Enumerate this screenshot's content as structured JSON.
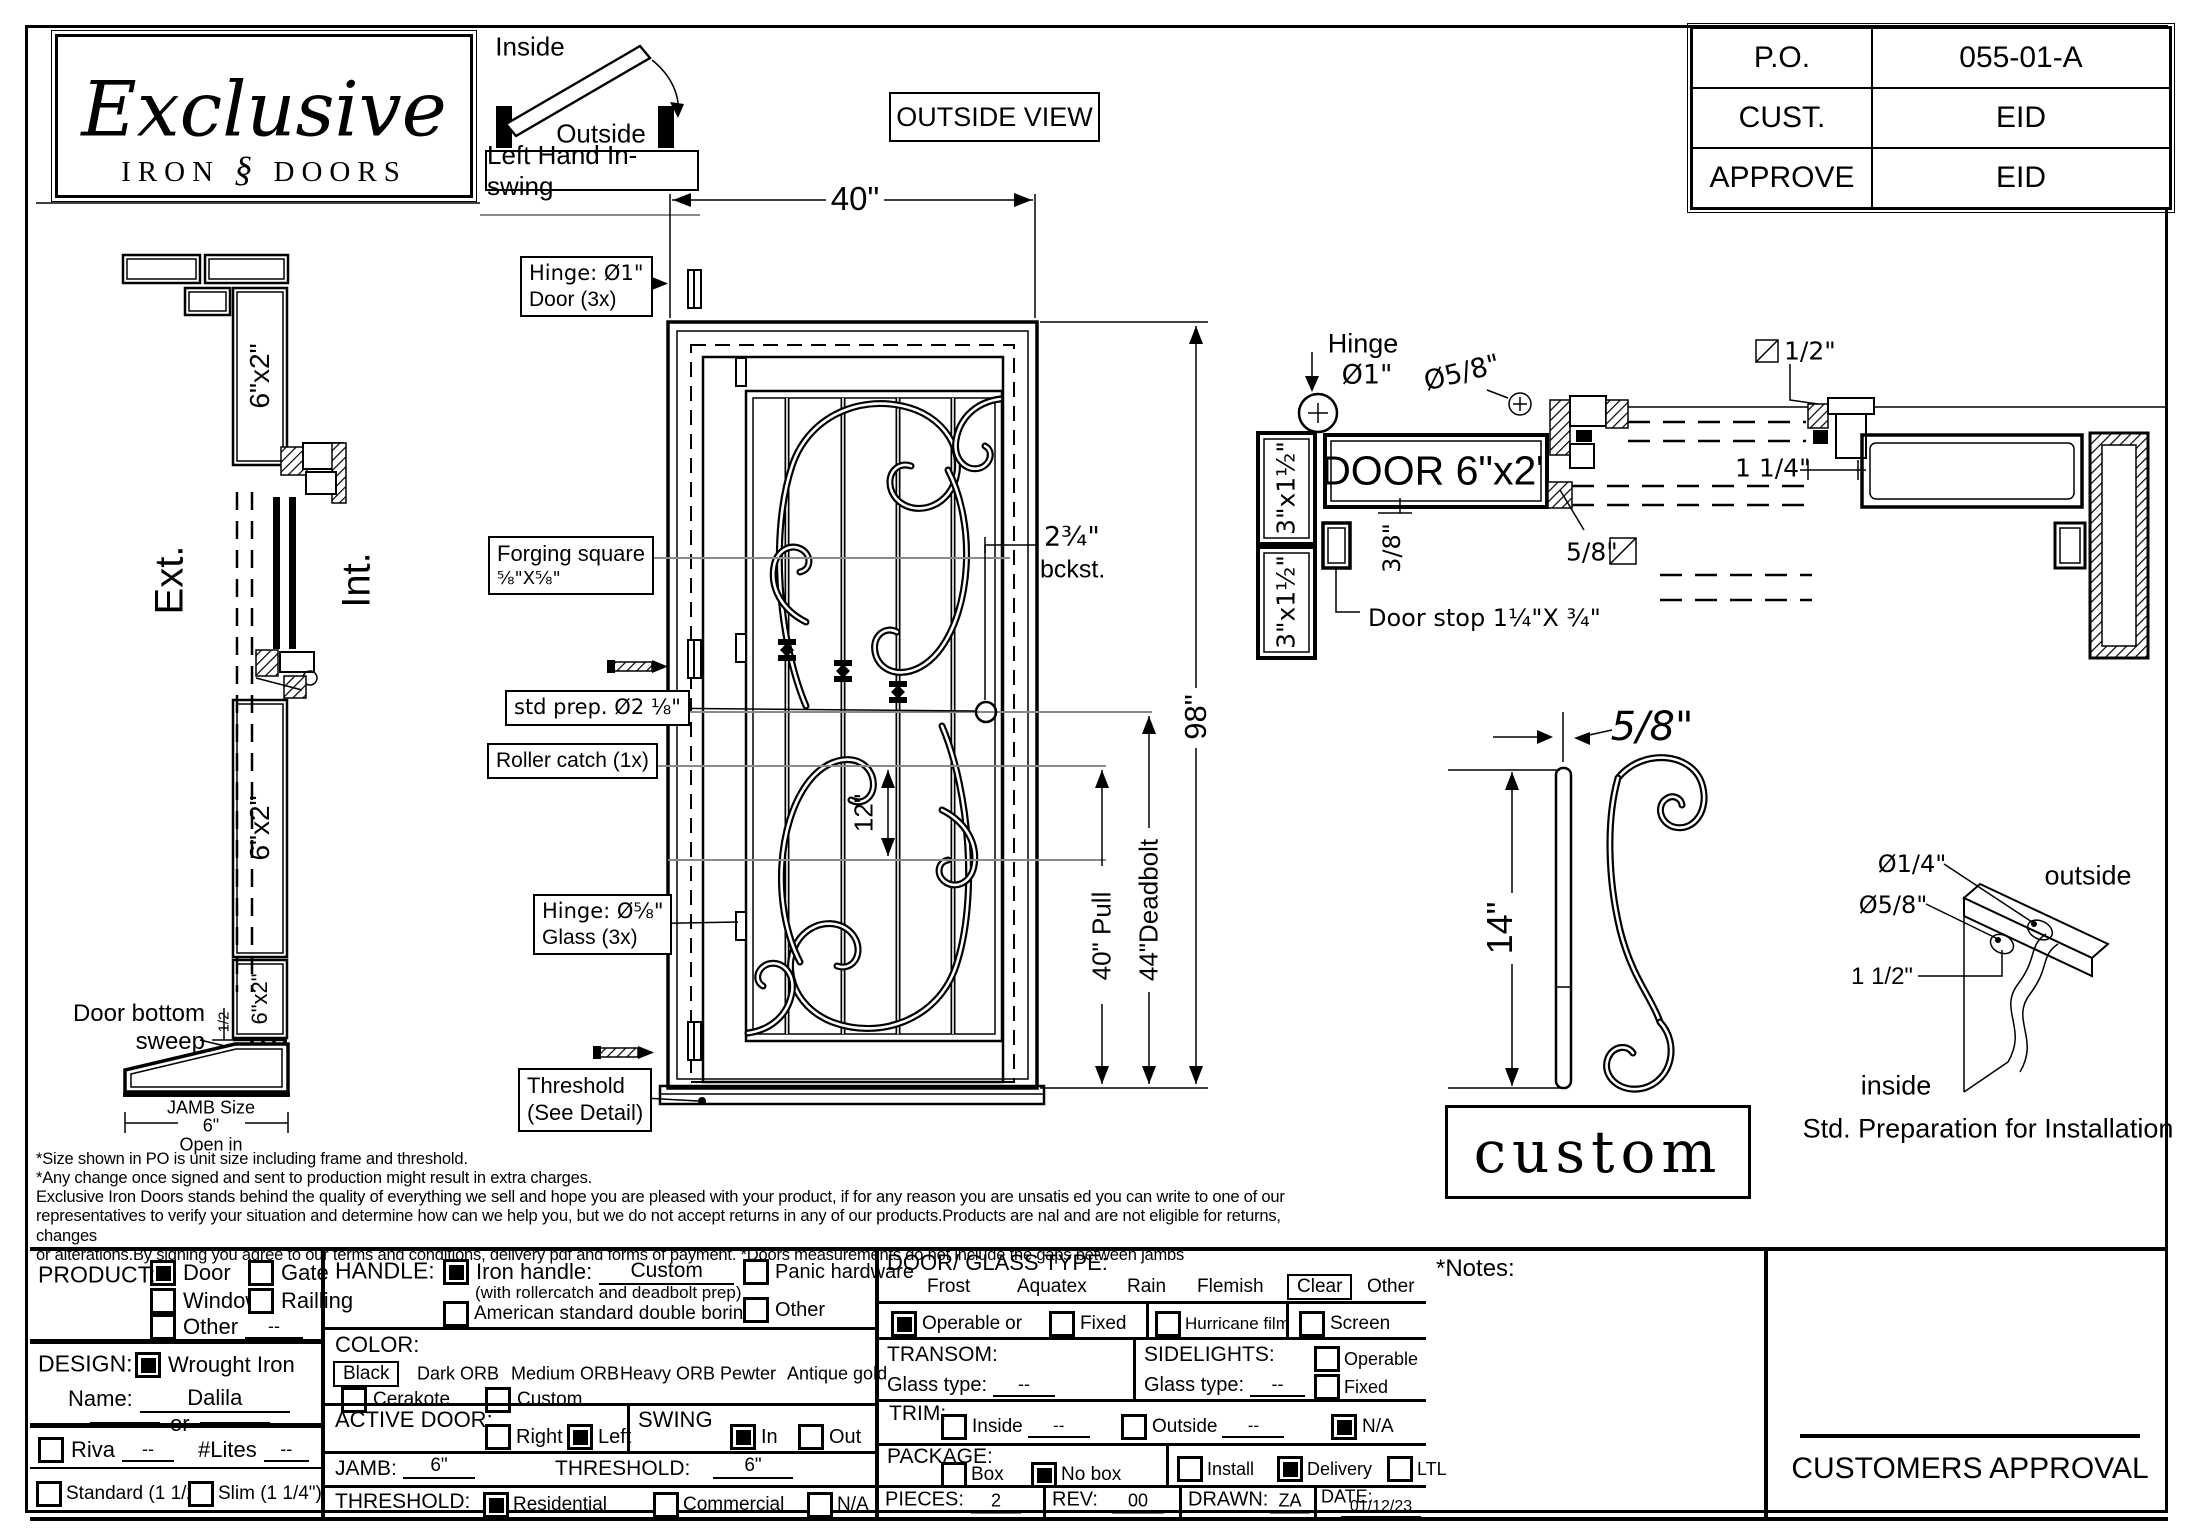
{
  "po_table": {
    "rows": [
      {
        "label": "P.O.",
        "value": "055-01-A"
      },
      {
        "label": "CUST.",
        "value": "EID"
      },
      {
        "label": "APPROVE",
        "value": "EID"
      }
    ]
  },
  "logo": {
    "script": "Exclusive",
    "sub_left": "IRON",
    "ornament": "§",
    "sub_right": "DOORS"
  },
  "swing_diagram": {
    "inside": "Inside",
    "outside": "Outside",
    "caption": "Left Hand In-swing"
  },
  "outside_view": "OUTSIDE VIEW",
  "section_view": {
    "ext": "Ext.",
    "int": "Int.",
    "frame_top": "6\"x2\"",
    "frame_mid": "6\"x2\"",
    "frame_bot": "6\"x2\"",
    "door_bottom_line1": "Door bottom",
    "door_bottom_line2": "sweep",
    "sweep_dim": "1/2",
    "jamb_size_label": "JAMB Size",
    "jamb_size_value": "6\"",
    "open_in": "Open in"
  },
  "elevation": {
    "width_dim": "40\"",
    "height_dim": "98\"",
    "bottom_dim": "12\"",
    "backset_line1": "2¾\"",
    "backset_line2": "bckst.",
    "pull_dim": "40\" Pull",
    "deadbolt_dim": "44\"Deadbolt",
    "labels": {
      "hinge_door_1": "Hinge: Ø1\"",
      "hinge_door_2": "Door (3x)",
      "forging_1": "Forging square",
      "forging_2": "⅝\"X⅝\"",
      "std_prep": "std prep. Ø2 ⅛\"",
      "roller_catch": "Roller catch  (1x)",
      "hinge_glass_1": "Hinge: Ø⅝\"",
      "hinge_glass_2": "Glass (3x)",
      "threshold_1": "Threshold",
      "threshold_2": "(See Detail)"
    }
  },
  "head_detail": {
    "hinge_label_1": "Hinge",
    "hinge_label_2": "Ø1\"",
    "dia_58": "Ø5/8\"",
    "door_label": "DOOR 6\"x2\"",
    "jamb_1": "3\"x1½\"",
    "jamb_2": "3\"x1½\"",
    "stop_offset": "3/8\"",
    "door_stop": "Door stop  1¼\"X ¾\"",
    "glass_thickness": "5/8\"",
    "half_sq": "1/2\"",
    "reveal": "1 1/4\""
  },
  "bar_detail": {
    "thickness": "5/8\"",
    "length": "14\"",
    "tag": "custom"
  },
  "install_detail": {
    "hole_small": "Ø1/4\"",
    "hole_large": "Ø5/8\"",
    "offset": "1 1/2\"",
    "outside": "outside",
    "inside": "inside",
    "caption": "Std. Preparation for Installation"
  },
  "disclaimer": {
    "lines": [
      "*Size shown in PO is unit size including frame and threshold.",
      "*Any change once signed and sent to production might result in extra charges.",
      "Exclusive Iron Doors stands behind the quality of everything we sell and hope you are pleased with your product, if for any reason you are unsatis  ed you can write to one of our",
      "representatives to verify your situation and determine how can we help you, but we do not accept returns in any of our products.Products are   nal and are not eligible for returns, changes",
      "or alterations.By signing you agree to our terms and conditions, delivery pdf and forms of payment. *Doors measurements do not include the gaps between jambs"
    ]
  },
  "form": {
    "product": {
      "label": "PRODUCT:",
      "door": "Door",
      "gate": "Gate",
      "window": "Window",
      "railling": "Railling",
      "other": "Other",
      "other_value": "--"
    },
    "design": {
      "label": "DESIGN:",
      "wrought": "Wrought Iron",
      "name_label": "Name:",
      "name_value": "Dalila",
      "or": "or",
      "riva": "Riva",
      "riva_value": "--",
      "lites_label": "#Lites",
      "lites_value": "--",
      "standard": "Standard (1 1/2\")",
      "slim": "Slim (1 1/4\")"
    },
    "handle": {
      "label": "HANDLE:",
      "iron": "Iron handle:",
      "iron_value": "Custom",
      "iron_note": "(with rollercatch and deadbolt prep)",
      "american": "American standard double boring",
      "panic": "Panic hardware",
      "other": "Other"
    },
    "color": {
      "label": "COLOR:",
      "selected": "Black",
      "opt1": "Dark ORB",
      "opt2": "Medium ORB",
      "opt3": "Heavy ORB",
      "opt4": "Pewter",
      "opt5": "Antique gold",
      "cerakote": "Cerakote",
      "custom": "Custom"
    },
    "active_door": {
      "label": "ACTIVE DOOR:",
      "right": "Right",
      "left": "Left"
    },
    "swing": {
      "label": "SWING",
      "in": "In",
      "out": "Out"
    },
    "jamb": {
      "label": "JAMB:",
      "value": "6\""
    },
    "threshold_size": {
      "label": "THRESHOLD:",
      "value": "6\""
    },
    "threshold_type": {
      "label": "THRESHOLD:",
      "residential": "Residential",
      "commercial": "Commercial",
      "na": "N/A"
    },
    "glass_type": {
      "label": "DOOR/ GLASS TYPE:",
      "opt1": "Frost",
      "opt2": "Aquatex",
      "opt3": "Rain",
      "opt4": "Flemish",
      "selected": "Clear",
      "other": "Other"
    },
    "operable_row": {
      "operable": "Operable",
      "or": "or",
      "fixed": "Fixed",
      "hurricane": "Hurricane film",
      "screen": "Screen"
    },
    "transom": {
      "label": "TRANSOM:",
      "glass_label": "Glass type:",
      "value": "--"
    },
    "sidelights": {
      "label": "SIDELIGHTS:",
      "glass_label": "Glass type:",
      "value": "--",
      "operable": "Operable",
      "fixed": "Fixed"
    },
    "trim": {
      "label": "TRIM:",
      "inside": "Inside",
      "inside_value": "--",
      "outside": "Outside",
      "outside_value": "--",
      "na": "N/A"
    },
    "package": {
      "label": "PACKAGE:",
      "box": "Box",
      "nobox": "No box",
      "install": "Install",
      "delivery": "Delivery",
      "ltl": "LTL"
    },
    "meta": {
      "pieces_label": "PIECES:",
      "pieces": "2",
      "rev_label": "REV:",
      "rev": "00",
      "drawn_label": "DRAWN:",
      "drawn": "ZA",
      "date_label": "DATE:",
      "date": "01/12/23"
    }
  },
  "notes_label": "*Notes:",
  "approval": "CUSTOMERS APPROVAL",
  "colors": {
    "line": "#000000",
    "reference_line": "#8a8a8a",
    "paper": "#ffffff"
  }
}
